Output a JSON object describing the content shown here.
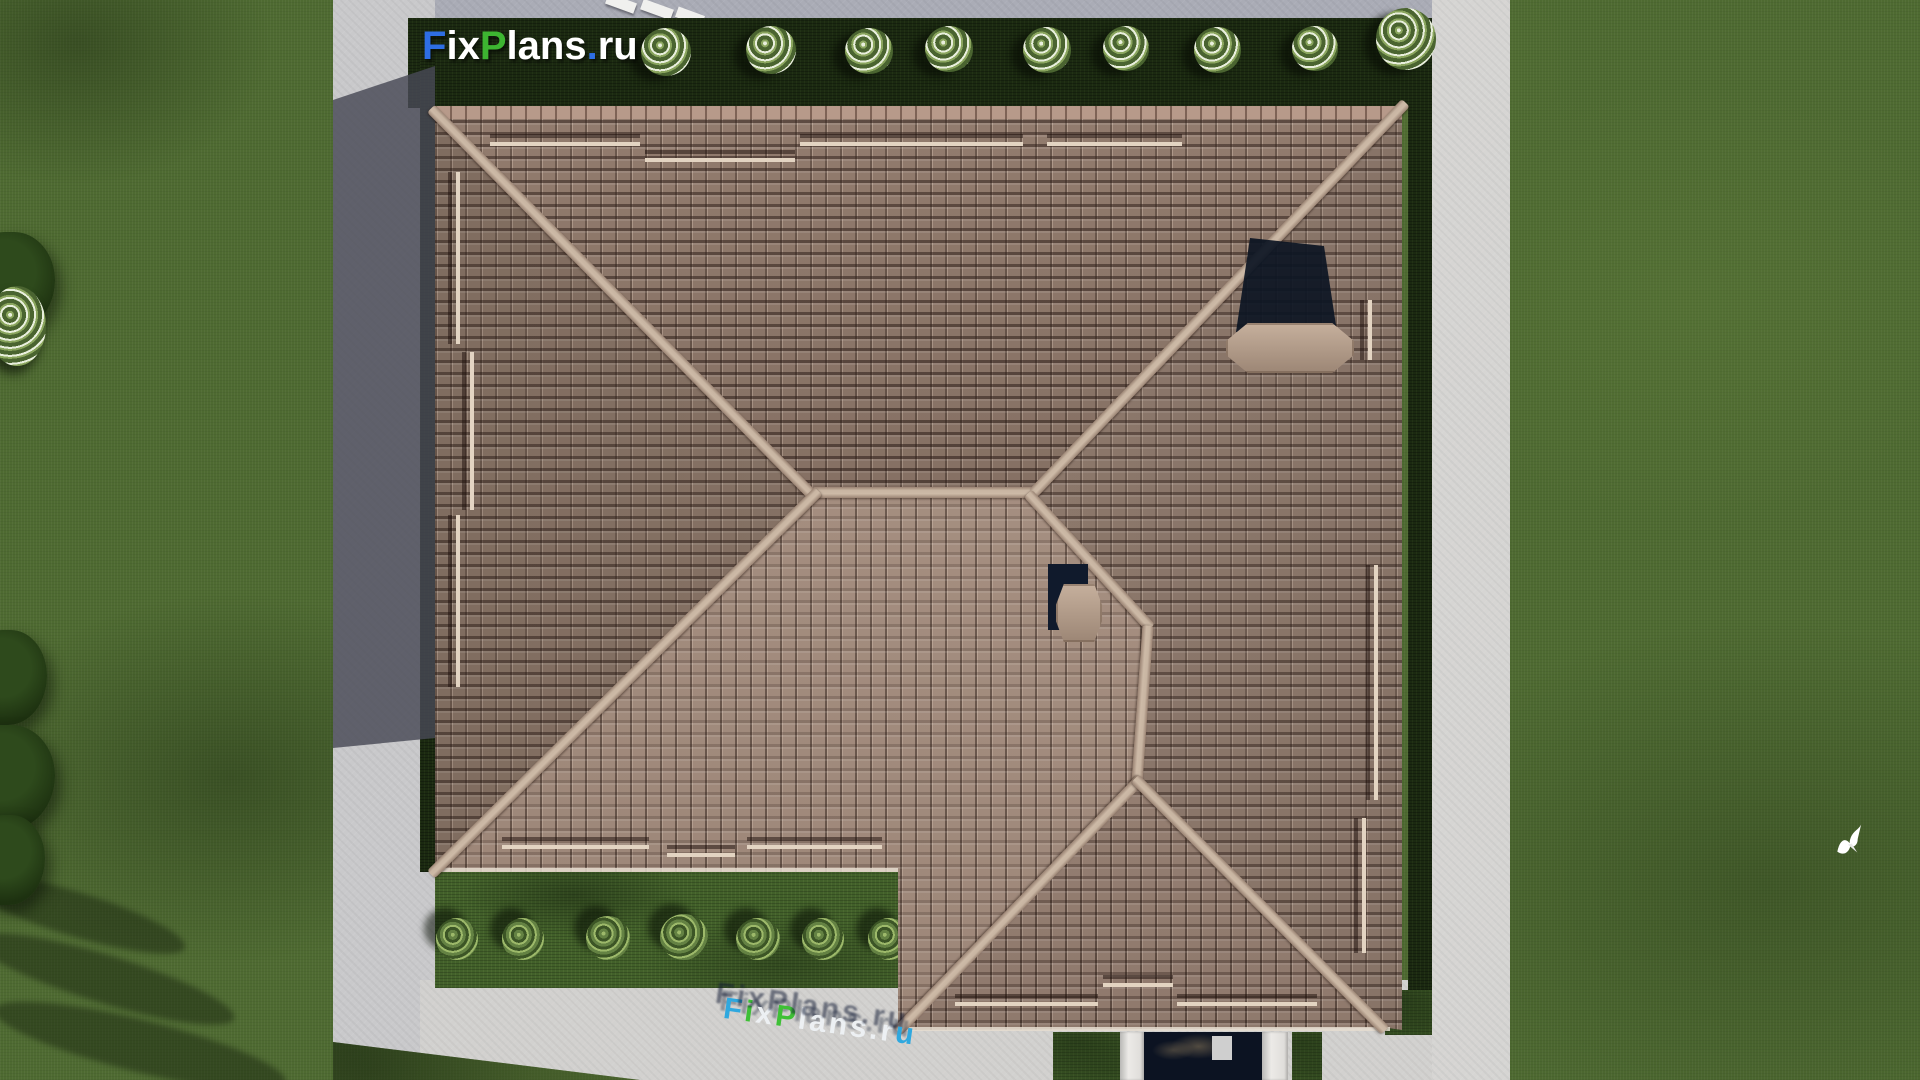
{
  "scene": {
    "description": "Aerial top-down 3D architectural render of a hip-roofed house with tiled roof, two chimneys, surrounding lawn, hedges with round bushes, paved walkways, an entrance with white pillars, and a white bird on the lawn",
    "brand": {
      "text": "FixPlans.ru",
      "blue": "#2e6ee3",
      "green": "#3db531",
      "white": "#ffffff"
    },
    "logo_watermark": {
      "text": "FixPlans.ru",
      "letters": [
        {
          "ch": "F",
          "color": "#2e6ee3"
        },
        {
          "ch": "i",
          "color": "#ffffff"
        },
        {
          "ch": "x",
          "color": "#ffffff"
        },
        {
          "ch": "P",
          "color": "#3db531"
        },
        {
          "ch": "l",
          "color": "#ffffff"
        },
        {
          "ch": "a",
          "color": "#ffffff"
        },
        {
          "ch": "n",
          "color": "#ffffff"
        },
        {
          "ch": "s",
          "color": "#ffffff"
        },
        {
          "ch": ".",
          "color": "#2e6ee3"
        },
        {
          "ch": "r",
          "color": "#ffffff"
        },
        {
          "ch": "u",
          "color": "#ffffff"
        }
      ]
    },
    "ground_watermark": {
      "text": "FixPlans.ru",
      "letters": [
        {
          "ch": "F",
          "color": "#2aa7e0"
        },
        {
          "ch": "i",
          "color": "#3ac032"
        },
        {
          "ch": "x",
          "color": "#eef2f5"
        },
        {
          "ch": "P",
          "color": "#3ac032"
        },
        {
          "ch": "l",
          "color": "#eef2f5"
        },
        {
          "ch": "a",
          "color": "#eef2f5"
        },
        {
          "ch": "n",
          "color": "#eef2f5"
        },
        {
          "ch": "s",
          "color": "#eef2f5"
        },
        {
          "ch": ".",
          "color": "#eef2f5"
        },
        {
          "ch": "r",
          "color": "#eef2f5"
        },
        {
          "ch": "u",
          "color": "#2aa7e0"
        }
      ]
    },
    "palette": {
      "grass": "#4e6a31",
      "hedge_dark": "#1b2911",
      "hedge_light": "#42602a",
      "pavement": "#c9c9cb",
      "pavement_bright": "#d6d5d3",
      "house_shadow": "#4b4c58",
      "roof_tile_sunlit": "#a58d7e",
      "roof_tile_shaded": "#8a7365",
      "ridge": "#c8b5a2",
      "door": "#0c1322",
      "pillar": "#e5e4e1",
      "chimney_shadow": "#0d1524",
      "bird": "#ffffff"
    }
  }
}
